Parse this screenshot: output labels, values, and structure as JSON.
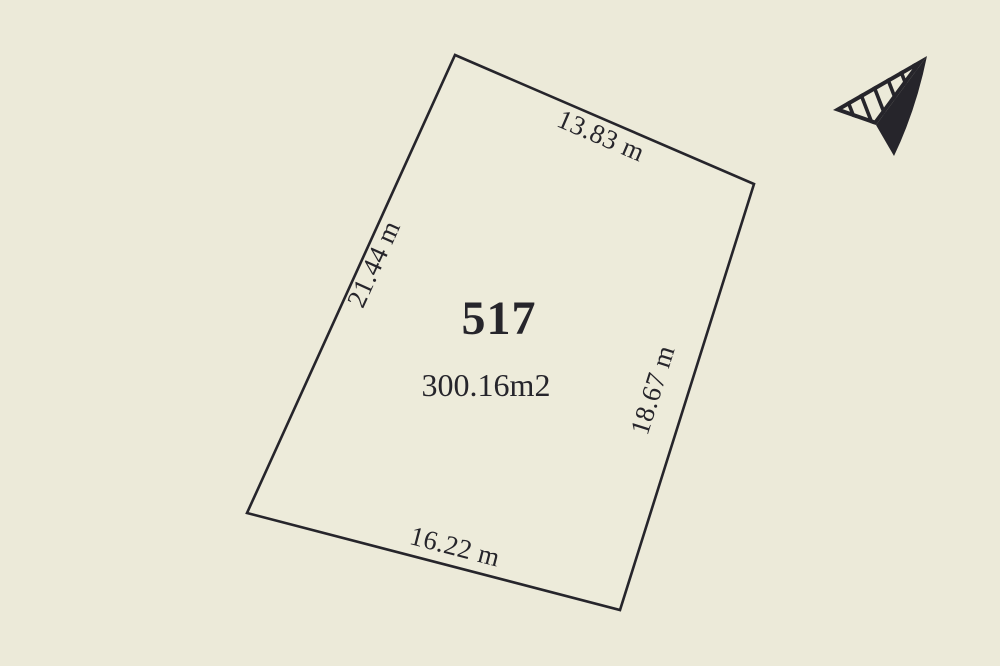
{
  "colors": {
    "background": "#ECEAD9",
    "ink": "#26252B"
  },
  "lot": {
    "number": "517",
    "area": "300.16m2",
    "sides": {
      "top": "13.83 m",
      "left": "21.44 m",
      "right": "18.67 m",
      "bottom": "16.22 m"
    }
  },
  "icons": {
    "north_arrow": "north-arrow-icon"
  }
}
